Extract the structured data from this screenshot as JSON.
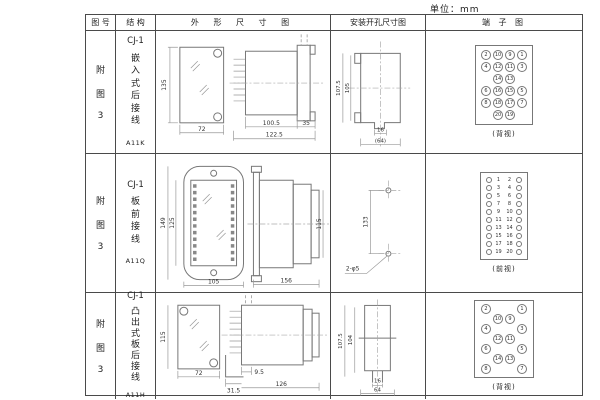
{
  "unit_label": "单位：mm",
  "table": {
    "headers": {
      "fig_no": "图 号",
      "structure": "结 构",
      "outline": "外 形 尺 寸 图",
      "install": "安装开孔尺寸图",
      "terminal": "端 子 图"
    },
    "rows": [
      {
        "fig_no": [
          "附",
          "图",
          "3"
        ],
        "structure_title": "CJ-1",
        "structure_chars": [
          "嵌",
          "入",
          "式",
          "后",
          "接",
          "线"
        ],
        "model": "A11K",
        "outline": {
          "front_h": "135",
          "front_w": "72",
          "d1": "100.5",
          "d2": "122.5",
          "d3": "35"
        },
        "install": {
          "v1": "107.5",
          "v2": "105",
          "h1": "16",
          "h2": "(64)"
        },
        "terminal": {
          "caption": "(背视)",
          "layout": "grid",
          "rows": [
            [
              2,
              10,
              9,
              1
            ],
            [
              4,
              12,
              11,
              3
            ],
            [
              null,
              14,
              13,
              null
            ],
            [
              6,
              16,
              15,
              5
            ],
            [
              8,
              18,
              17,
              7
            ],
            [
              null,
              20,
              19,
              null
            ]
          ]
        }
      },
      {
        "fig_no": [
          "附",
          "图",
          "3"
        ],
        "structure_title": "CJ-1",
        "structure_chars": [
          "板",
          "前",
          "接",
          "线"
        ],
        "model": "A11Q",
        "outline": {
          "front_h": "149",
          "front_h2": "125",
          "front_w": "105",
          "side_l": "156",
          "side_h": "115"
        },
        "install": {
          "v1": "133",
          "hole": "2-φ5"
        },
        "terminal": {
          "caption": "(前视)",
          "layout": "strip",
          "rows": [
            [
              1,
              2
            ],
            [
              3,
              4
            ],
            [
              5,
              6
            ],
            [
              7,
              8
            ],
            [
              9,
              10
            ],
            [
              11,
              12
            ],
            [
              13,
              14
            ],
            [
              15,
              16
            ],
            [
              17,
              18
            ],
            [
              19,
              20
            ]
          ]
        }
      },
      {
        "fig_no": [
          "附",
          "图",
          "3"
        ],
        "structure_title": "CJ-1",
        "structure_chars": [
          "凸",
          "出",
          "式",
          "板",
          "后",
          "接",
          "线"
        ],
        "model": "A11H",
        "outline": {
          "front_h": "115",
          "front_w": "72",
          "d1": "31.5",
          "d2": "9.5",
          "d3": "126"
        },
        "install": {
          "v1": "107.5",
          "v2": "104",
          "h1": "16",
          "h2": "64"
        },
        "terminal": {
          "caption": "(背视)",
          "layout": "grid",
          "rows": [
            [
              2,
              null,
              null,
              1
            ],
            [
              null,
              10,
              9,
              null
            ],
            [
              4,
              null,
              null,
              3
            ],
            [
              null,
              12,
              11,
              null
            ],
            [
              6,
              null,
              null,
              5
            ],
            [
              null,
              14,
              13,
              null
            ],
            [
              8,
              null,
              null,
              7
            ]
          ]
        }
      }
    ]
  }
}
